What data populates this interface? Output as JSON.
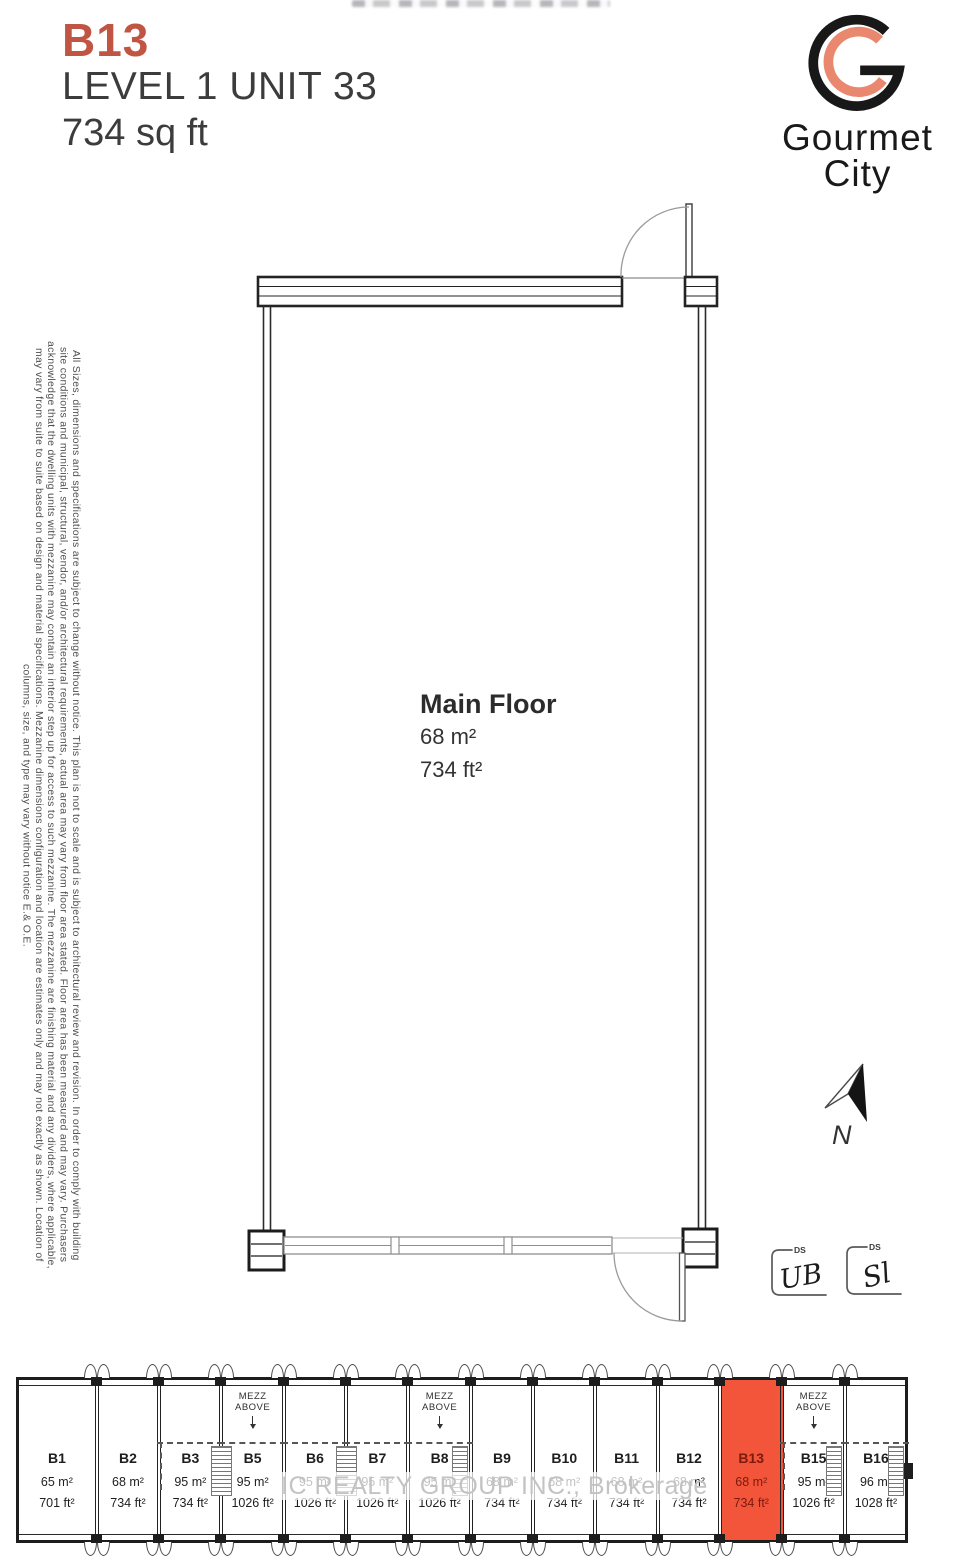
{
  "title": {
    "unit_code": "B13",
    "subtitle": "LEVEL 1 UNIT 33",
    "area": "734 sq ft",
    "accent_color": "#c05544"
  },
  "logo": {
    "brand_line1": "Gourmet",
    "brand_line2": "City",
    "mark_black": "#181818",
    "mark_salmon": "#e9886e"
  },
  "disclaimer": {
    "lines": [
      "All Sizes, dimensions and specifications are subject to change without notice. This plan is not to scale and is subject to architectural review and revision. In order to comply with building",
      "site conditions and municipal, structural, vendor, and/or architectural requirements, actual area may vary from floor area stated. Floor area has been measured and may vary. Purchasers",
      "acknowledge that the dwelling units with mezzanine may contain an interior step up for access to such mezzanine. The mezzanine are finishing material and any dividers, where applicable,",
      "may vary from suite to suite based on design and material specifications. Mezzanine dimensions configuration and location are estimates only and may not exactly as shown. Location of",
      "columns, size, and type may vary without notice E.& O.E."
    ]
  },
  "plan": {
    "room_label": "Main Floor",
    "area_m2": "68 m²",
    "area_ft2": "734 ft²"
  },
  "north_arrow": {
    "label": "N"
  },
  "signatures": [
    {
      "tag": "DS",
      "initials": "UB"
    },
    {
      "tag": "DS",
      "initials": "Sl"
    }
  ],
  "watermark": {
    "text": "IC REALTY GROUP INC., Brokerage"
  },
  "keyplan": {
    "highlight_color": "#f2553a",
    "highlight_text_color": "#7c1a0d",
    "mezz_label_line1": "MEZZ",
    "mezz_label_line2": "ABOVE",
    "units": [
      {
        "id": "B1",
        "m2": "65 m²",
        "ft2": "701 ft²",
        "wide": true
      },
      {
        "id": "B2",
        "m2": "68 m²",
        "ft2": "734 ft²"
      },
      {
        "id": "B3",
        "m2": "95 m²",
        "ft2": "734 ft²",
        "dash": true,
        "dashstart": true,
        "stairs": true
      },
      {
        "id": "B5",
        "m2": "95 m²",
        "ft2": "1026 ft²",
        "dash": true,
        "mezz": true
      },
      {
        "id": "B6",
        "m2": "95 m²",
        "ft2": "1026 ft²",
        "dash": true,
        "stairs": true
      },
      {
        "id": "B7",
        "m2": "95 m²",
        "ft2": "1026 ft²",
        "dash": true
      },
      {
        "id": "B8",
        "m2": "95 m²",
        "ft2": "1026 ft²",
        "dash": true,
        "mezz": true,
        "stairs": true,
        "stairs_inside": true
      },
      {
        "id": "B9",
        "m2": "68 m²",
        "ft2": "734 ft²"
      },
      {
        "id": "B10",
        "m2": "68 m²",
        "ft2": "734 ft²"
      },
      {
        "id": "B11",
        "m2": "68 m²",
        "ft2": "734 ft²"
      },
      {
        "id": "B12",
        "m2": "68 m²",
        "ft2": "734 ft²"
      },
      {
        "id": "B13",
        "m2": "68 m²",
        "ft2": "734 ft²",
        "highlight": true
      },
      {
        "id": "B15",
        "m2": "95 m²",
        "ft2": "1026 ft²",
        "dash": true,
        "dashstart": true,
        "mezz": true,
        "stairs": true,
        "stairs_inside": true
      },
      {
        "id": "B16",
        "m2": "96 m²",
        "ft2": "1028 ft²",
        "dash": true,
        "stairs": true,
        "stairs_inside": true
      }
    ]
  }
}
